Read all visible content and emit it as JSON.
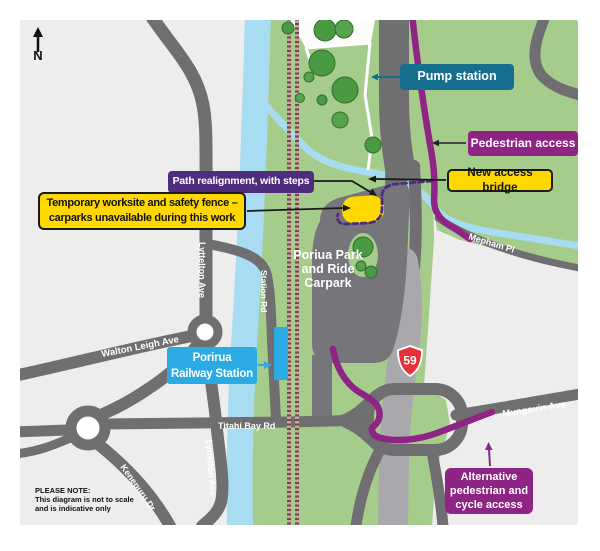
{
  "compass": {
    "label": "N"
  },
  "callouts": {
    "pump_station": {
      "label": "Pump station"
    },
    "pedestrian_access": {
      "label": "Pedestrian access"
    },
    "path_realignment": {
      "label": "Path realignment, with steps"
    },
    "new_access_bridge": {
      "label": "New access bridge"
    },
    "temporary_worksite": {
      "line1": "Temporary worksite and safety fence –",
      "line2": "carparks unavailable during this work"
    },
    "railway_station": {
      "line1": "Porirua",
      "line2": "Railway Station"
    },
    "alternative_access": {
      "line1": "Alternative",
      "line2": "pedestrian and",
      "line3": "cycle access"
    }
  },
  "map_labels": {
    "park_and_ride": {
      "line1": "Poriua",
      "line2": "Park",
      "line3": "and",
      "line4": "Ride",
      "line5": "Carpark"
    },
    "highway_shield": "59",
    "roads": {
      "walton_leigh": "Walton Leigh Ave",
      "titahi_bay": "Titahi Bay Rd",
      "lyttelton_upper": "Lyttelton Ave",
      "lyttelton_lower": "Lyttelton Ave",
      "kenepuru": "Kenepuru Dr",
      "station_rd": "Station Rd",
      "mungavin": "Mungavin Ave",
      "mepham": "Mepham Pl"
    }
  },
  "note": {
    "line1": "PLEASE NOTE:",
    "line2": "This diagram is not to scale",
    "line3": "and is indicative only"
  },
  "colors": {
    "teal": "#176f8f",
    "purple": "#8e2483",
    "violet": "#4e2d7e",
    "yellow": "#ffd800",
    "station_blue": "#2aabe3",
    "green": "#a6cc8c",
    "water": "#a8dcf2",
    "road_gray": "#6f6f72",
    "motorway_gray": "#a9a9ad",
    "highway_red": "#e23138"
  }
}
